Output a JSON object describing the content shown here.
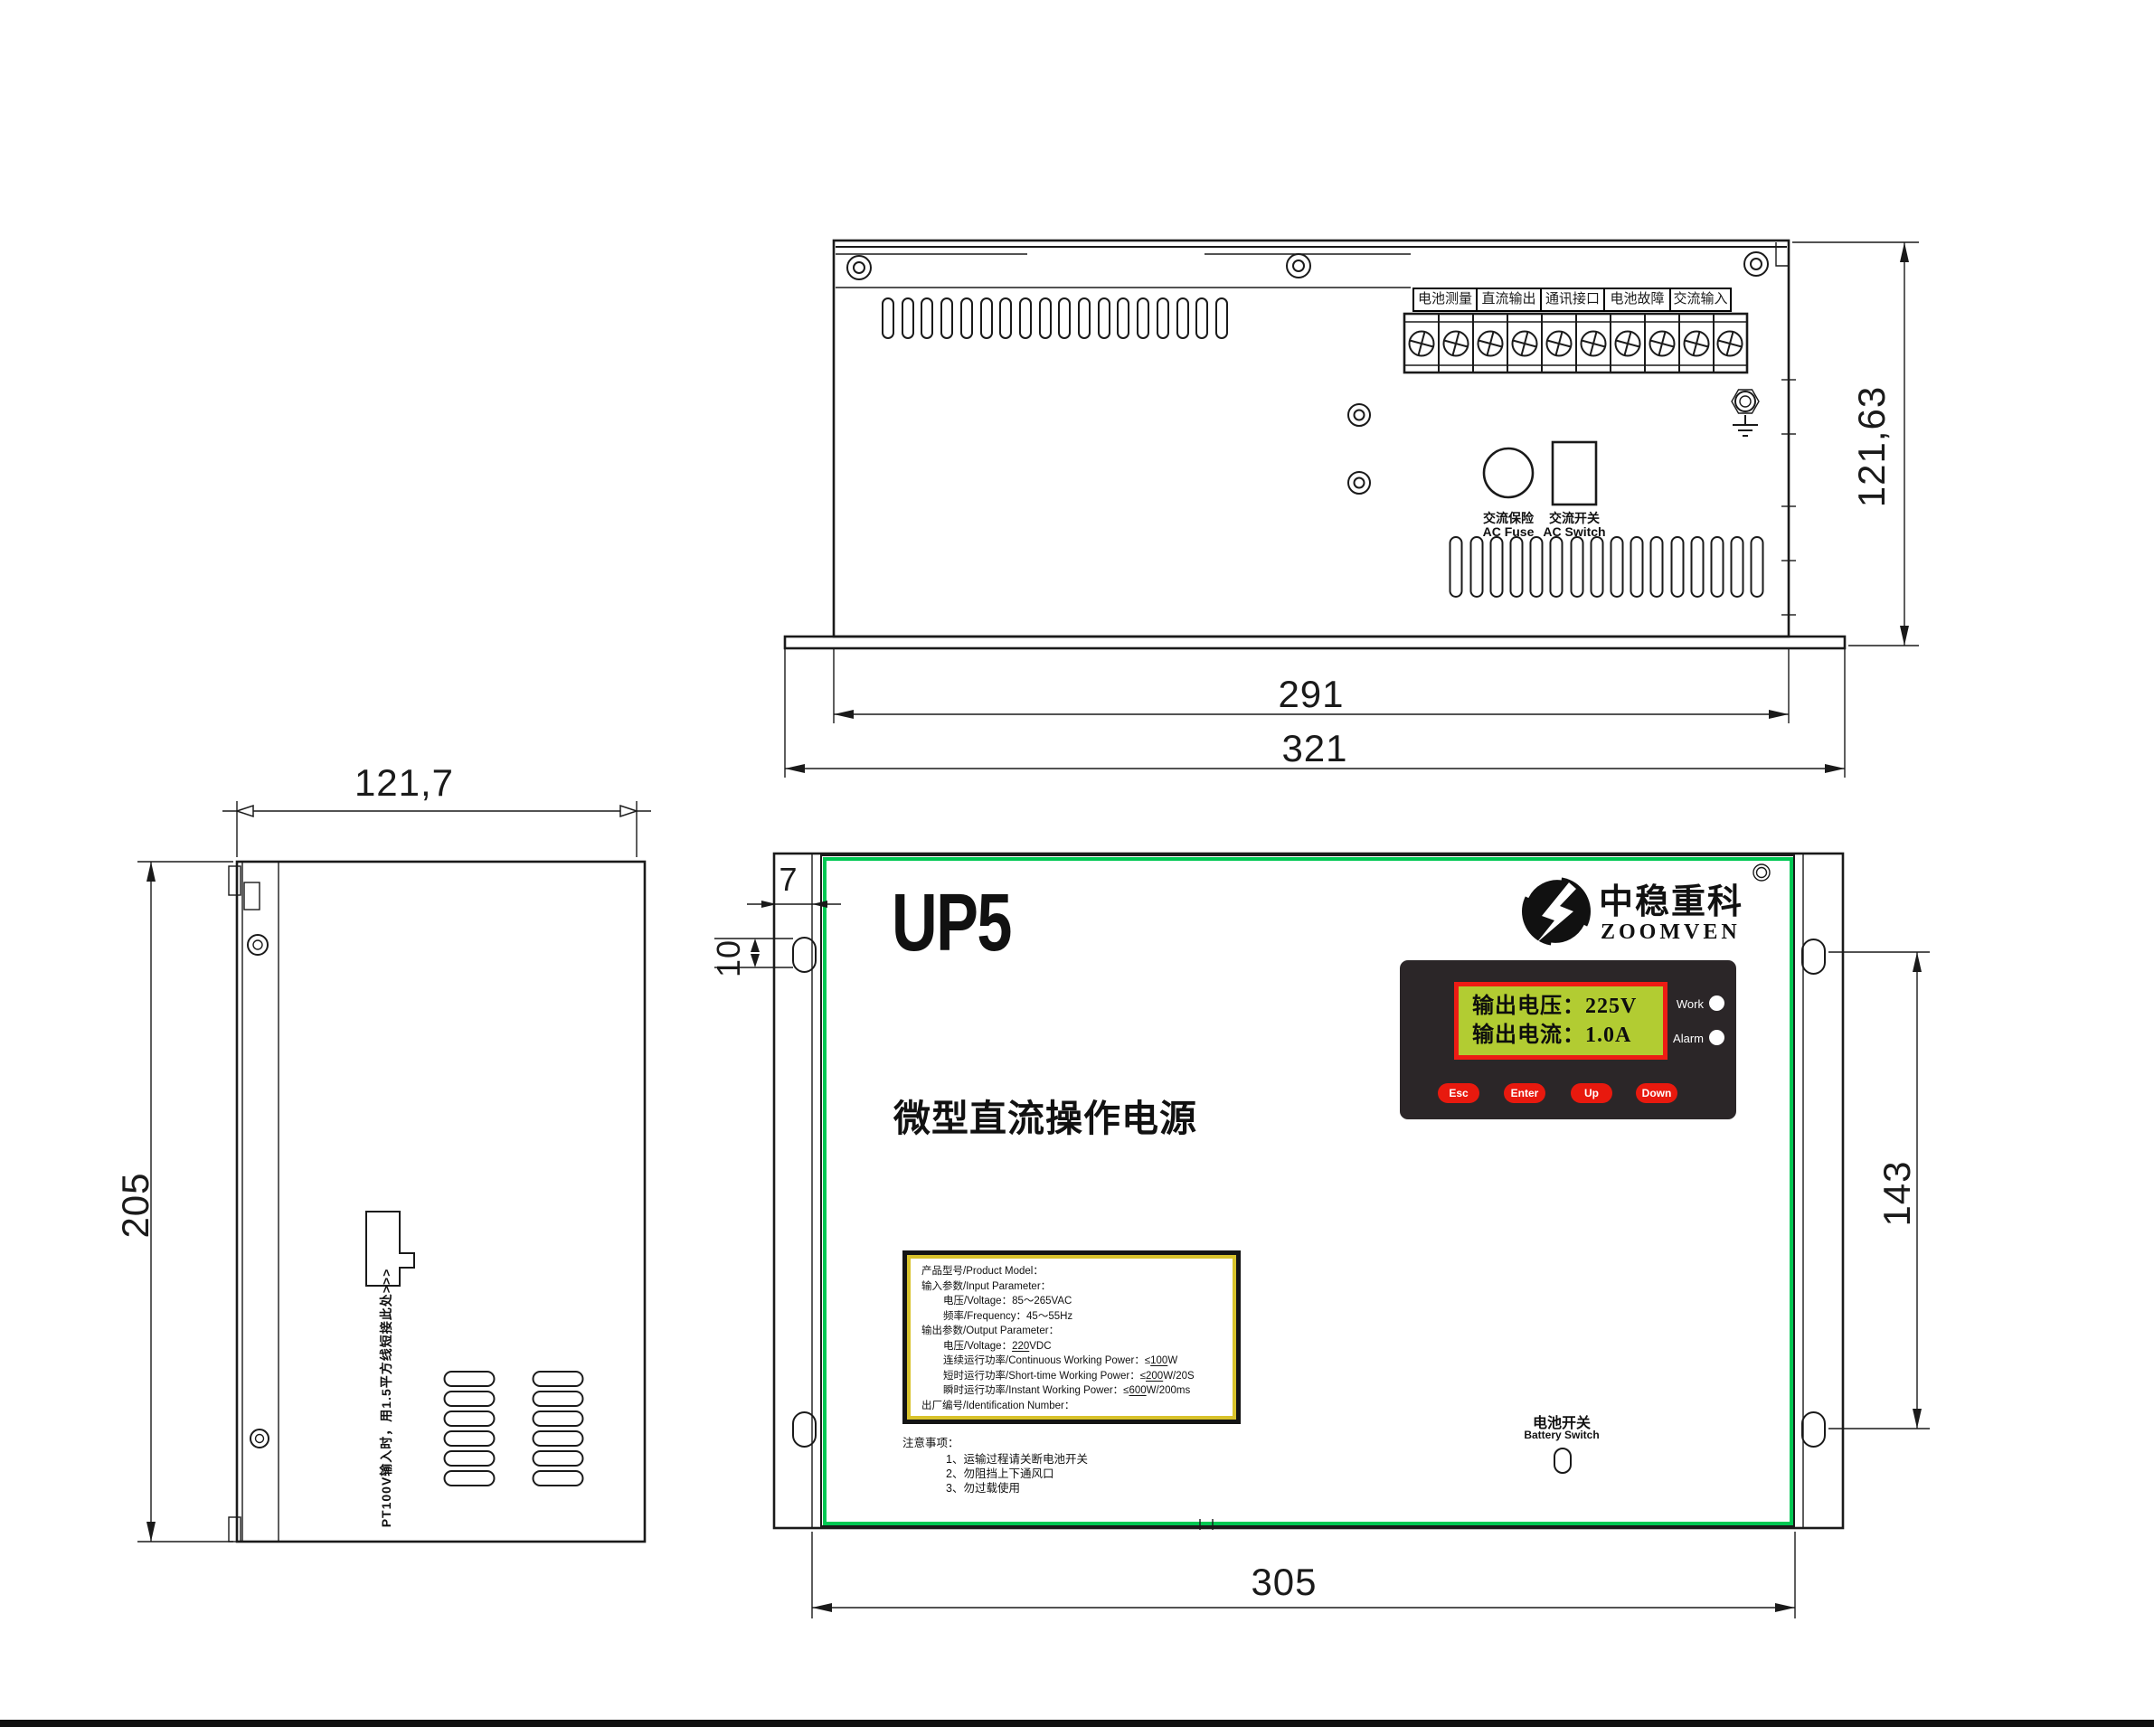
{
  "drawing": {
    "views": {
      "top": {
        "terminal_labels": [
          "电池测量",
          "直流输出",
          "通讯接口",
          "电池故障",
          "交流输入"
        ],
        "ac_fuse": {
          "cn": "交流保险",
          "en": "AC Fuse"
        },
        "ac_switch": {
          "cn": "交流开关",
          "en": "AC Switch"
        },
        "dims": {
          "depth": "121,63",
          "body_width": "291",
          "overall_width": "321"
        }
      },
      "side": {
        "note": "PT100V输入时，用1.5平方线短接此处>>>",
        "dims": {
          "width": "121,7",
          "height": "205"
        }
      },
      "front": {
        "model": "UP5",
        "title": "微型直流操作电源",
        "brand": {
          "cn": "中稳重科",
          "en": "ZOOMVEN"
        },
        "display": {
          "line1": "输出电压：225V",
          "line2": "输出电流：1.0A",
          "led_work": "Work",
          "led_alarm": "Alarm",
          "buttons": [
            "Esc",
            "Enter",
            "Up",
            "Down"
          ]
        },
        "battery_switch": {
          "cn": "电池开关",
          "en": "Battery Switch"
        },
        "label": {
          "lines": [
            {
              "pre": "产品型号/Product Model："
            },
            {
              "pre": "输入参数/Input Parameter："
            },
            {
              "pre": "电压/Voltage：85～265VAC"
            },
            {
              "pre": "频率/Frequency：45～55Hz"
            },
            {
              "pre": "输出参数/Output Parameter："
            },
            {
              "pre": "电压/Voltage：",
              "u": "220",
              "post": "VDC"
            },
            {
              "pre": "连续运行功率/Continuous Working Power：≤",
              "u": "100",
              "post": "W"
            },
            {
              "pre": "短时运行功率/Short-time Working Power：≤",
              "u": "200",
              "post": "W/20S"
            },
            {
              "pre": "瞬时运行功率/Instant Working Power：≤",
              "u": "600",
              "post": "W/200ms"
            },
            {
              "pre": "出厂编号/Identification Number："
            }
          ]
        },
        "notes": {
          "title": "注意事项：",
          "items": [
            "1、运输过程请关断电池开关",
            "2、勿阻挡上下通风口",
            "3、勿过载使用"
          ]
        },
        "dims": {
          "flange_offset": "7",
          "slot_length": "10",
          "mount_height": "143",
          "mount_width": "305"
        }
      }
    },
    "colors": {
      "accent_green": "#00c853",
      "lcd_bg": "#b2cc32",
      "lcd_border_red": "#ed1c14",
      "panel_black": "#2b2628",
      "button_red": "#e8190e",
      "label_frame_yellow": "#d8c22b",
      "line_black": "#1a1a1a"
    }
  }
}
